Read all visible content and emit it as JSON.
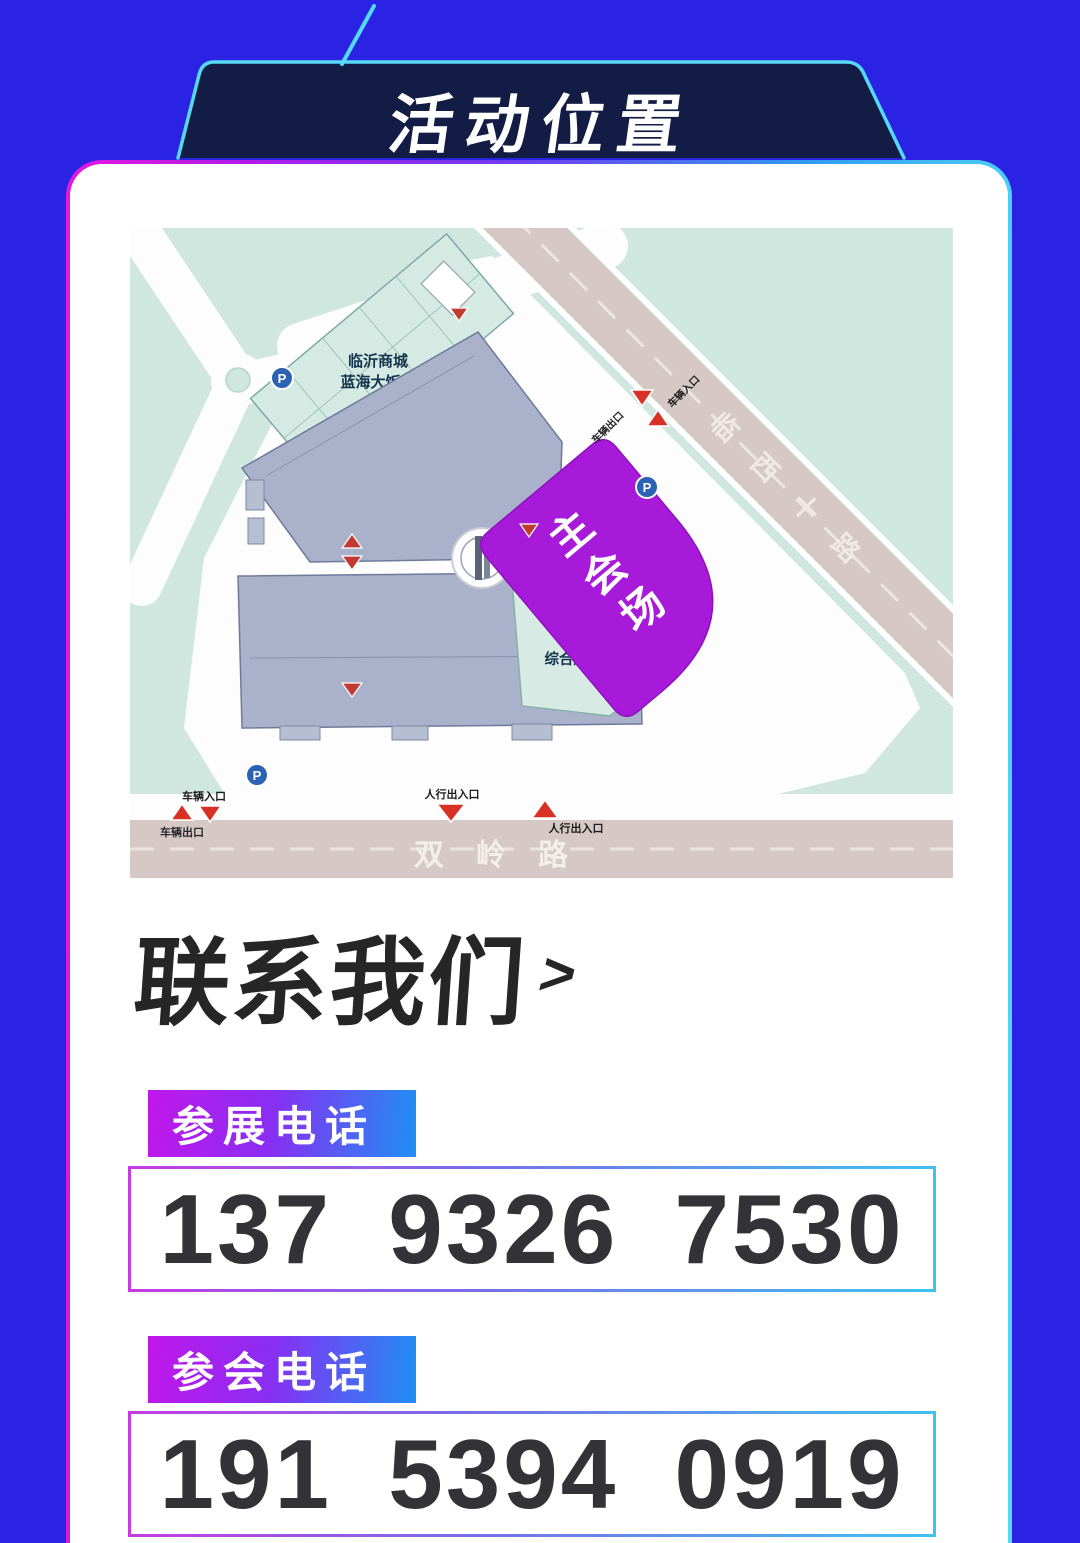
{
  "banner": {
    "title": "活动位置"
  },
  "map": {
    "hotel_line1": "临沂商城",
    "hotel_line2": "蓝海大饭店",
    "service_center": "综合服务中心",
    "main_venue": "主会场",
    "road_diagonal": "临西十路",
    "road_bottom": "双岭路",
    "vehicle_exit": "车辆出口",
    "vehicle_entry": "车辆入口",
    "pedestrian_access": "人行出入口",
    "parking": "P"
  },
  "contact": {
    "heading": "联系我们",
    "arrow": ">",
    "items": [
      {
        "label": "参展电话",
        "phone": "137 9326 7530"
      },
      {
        "label": "参会电话",
        "phone": "191 5394 0919"
      }
    ]
  },
  "colors": {
    "background": "#2a23e4",
    "banner_fill": "#131c45",
    "banner_stroke": "#55d9f7",
    "accent_magenta": "#d816dc",
    "accent_cyan": "#44c6f4",
    "venue_purple": "#a71ada",
    "marker_red": "#d93025"
  }
}
